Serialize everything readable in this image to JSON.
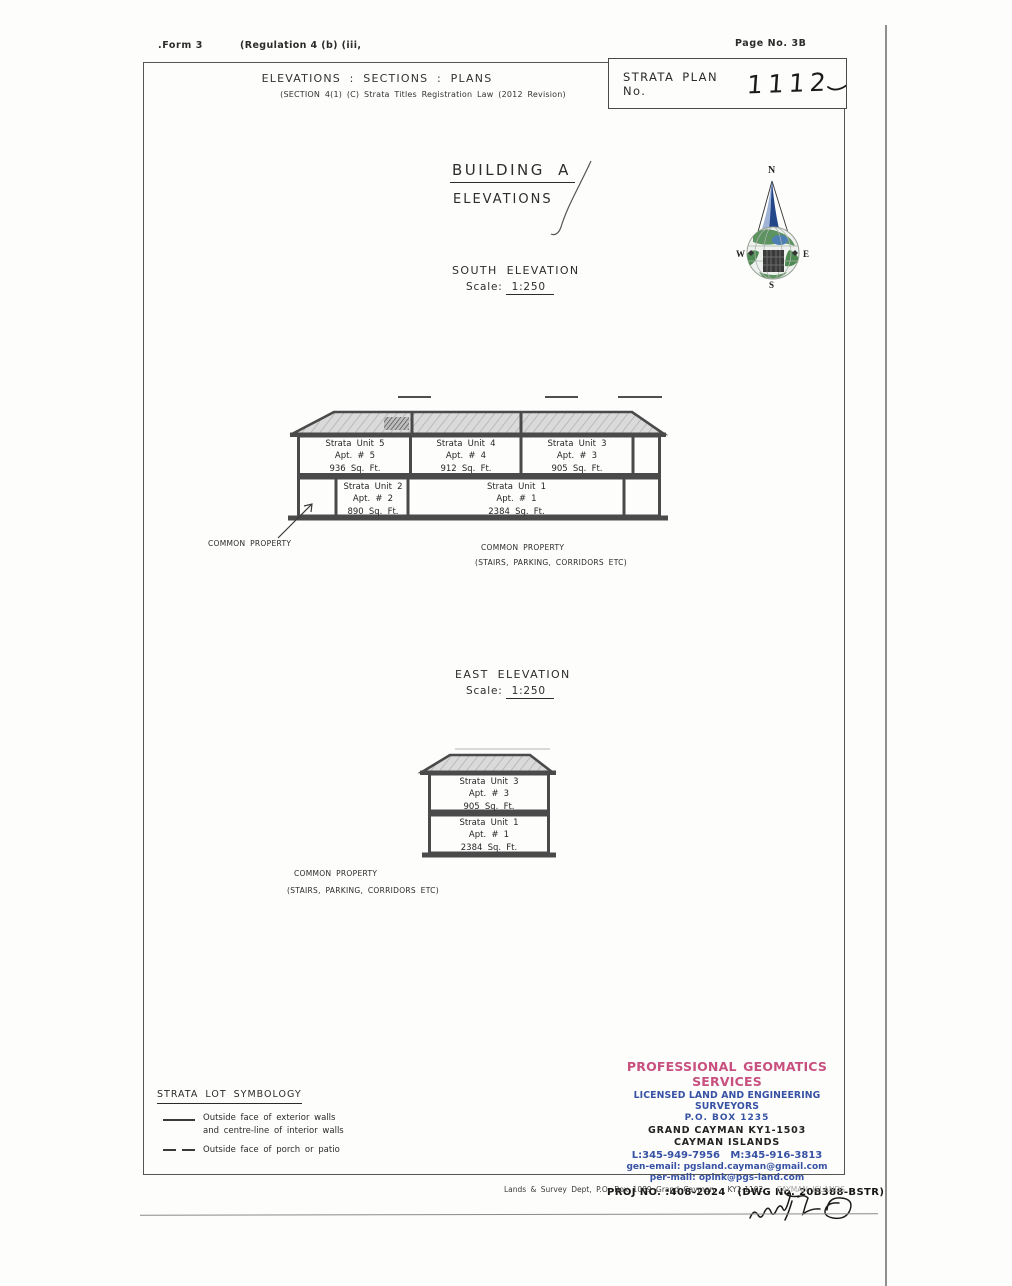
{
  "header": {
    "form": ".Form 3",
    "regulation": "(Regulation 4 (b) (iii,",
    "page_no": "Page No. 3B"
  },
  "title_block": {
    "title": "ELEVATIONS : SECTIONS : PLANS",
    "subtitle": "(SECTION 4(1) (C) Strata Titles Registration Law (2012 Revision)",
    "strata_plan_label": "STRATA PLAN No.",
    "strata_plan_number": "1112"
  },
  "building": {
    "title": "BUILDING A",
    "subtitle": "ELEVATIONS"
  },
  "compass": {
    "north": "N",
    "east": "E",
    "south": "S",
    "west": "W"
  },
  "south_elevation": {
    "title": "SOUTH ELEVATION",
    "scale_label": "Scale:",
    "scale_value": "1:250",
    "units_upper": [
      {
        "name": "Strata Unit 5",
        "apt": "Apt. # 5",
        "area": "936 Sq. Ft."
      },
      {
        "name": "Strata Unit 4",
        "apt": "Apt. # 4",
        "area": "912 Sq. Ft."
      },
      {
        "name": "Strata Unit 3",
        "apt": "Apt. # 3",
        "area": "905 Sq. Ft."
      }
    ],
    "units_lower": [
      {
        "name": "Strata Unit 2",
        "apt": "Apt. # 2",
        "area": "890 Sq. Ft."
      },
      {
        "name": "Strata Unit 1",
        "apt": "Apt. # 1",
        "area": "2384 Sq. Ft."
      }
    ],
    "common_property_pointer": "COMMON PROPERTY",
    "common_property": "COMMON PROPERTY",
    "common_property_detail": "(STAIRS, PARKING, CORRIDORS ETC)"
  },
  "east_elevation": {
    "title": "EAST ELEVATION",
    "scale_label": "Scale:",
    "scale_value": "1:250",
    "units": [
      {
        "name": "Strata Unit 3",
        "apt": "Apt. # 3",
        "area": "905 Sq. Ft."
      },
      {
        "name": "Strata Unit 1",
        "apt": "Apt. # 1",
        "area": "2384 Sq. Ft."
      }
    ],
    "common_property": "COMMON PROPERTY",
    "common_property_detail": "(STAIRS, PARKING, CORRIDORS ETC)"
  },
  "symbology": {
    "title": "STRATA LOT SYMBOLOGY",
    "items": [
      {
        "symbol": "solid-line",
        "line1": "Outside face of exterior walls",
        "line2": "and centre-line of interior walls"
      },
      {
        "symbol": "dashed-line",
        "line1": "Outside face of porch or patio",
        "line2": ""
      }
    ]
  },
  "surveyor": {
    "company": "PROFESSIONAL GEOMATICS SERVICES",
    "tagline": "LICENSED LAND AND ENGINEERING SURVEYORS",
    "po_box": "P.O. BOX 1235",
    "city": "GRAND CAYMAN KY1-1503",
    "country": "CAYMAN ISLANDS",
    "phones": "L:345-949-7956   M:345-916-3813",
    "gen_email": "gen-email: pgsland.cayman@gmail.com",
    "per_email": "per-mail: opink@pgs-land.com",
    "proj_no": "PROJ NO. :408-2024   (DWG No. 20B388-BSTR)",
    "colors": {
      "accent_pink": "#c8507e",
      "accent_blue": "#3752a4"
    }
  },
  "footer": {
    "dept_line": "Lands & Survey Dept, P.O. Box 1089 Grand Cayman   KY1-1102   ",
    "dept_line_faded": "CAYMAN ISLANDS"
  }
}
